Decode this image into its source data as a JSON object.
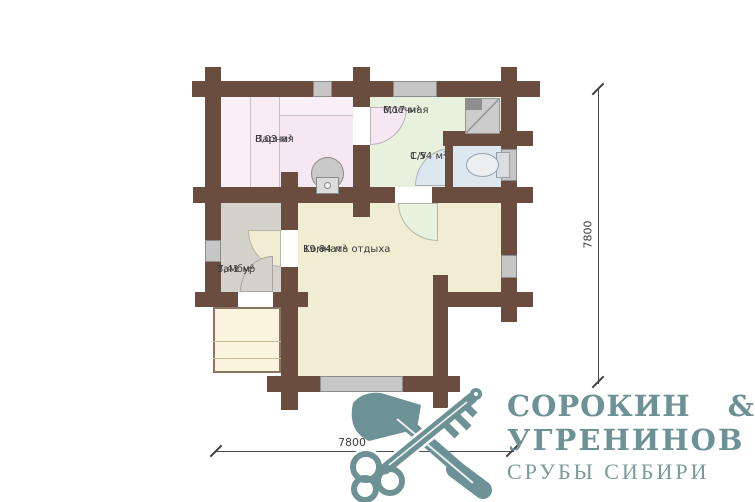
{
  "plan": {
    "rooms": [
      {
        "name": "Парная",
        "area": "8,03 м²"
      },
      {
        "name": "Моечная",
        "area": "6,17 м²"
      },
      {
        "name": "С/У",
        "area": "1,54 м²"
      },
      {
        "name": "Комната отдыха",
        "area": "19,94 м²"
      },
      {
        "name": "Тамбур",
        "area": "3,41 м²"
      }
    ],
    "dimensions": {
      "right": "7800",
      "bottom": "7800"
    }
  },
  "brand": {
    "line1": "СОРОКИН &",
    "line2": "УГРЕНИНОВ",
    "tagline": "СРУБЫ СИБИРИ"
  },
  "colors": {
    "wall": "#6a4d3e",
    "parnaya": "#f6e8f2",
    "moechnaya": "#e8f1de",
    "su": "#dce7f0",
    "living": "#f1edd2",
    "tambur": "#d5d2cb",
    "porch": "#fbf5e0",
    "window": "#c6c6c6",
    "logo": "#6d9295"
  },
  "icons": {
    "logo_icon": "crossed-axe-and-key",
    "fixtures": [
      "stove",
      "shower-tray",
      "toilet"
    ]
  }
}
